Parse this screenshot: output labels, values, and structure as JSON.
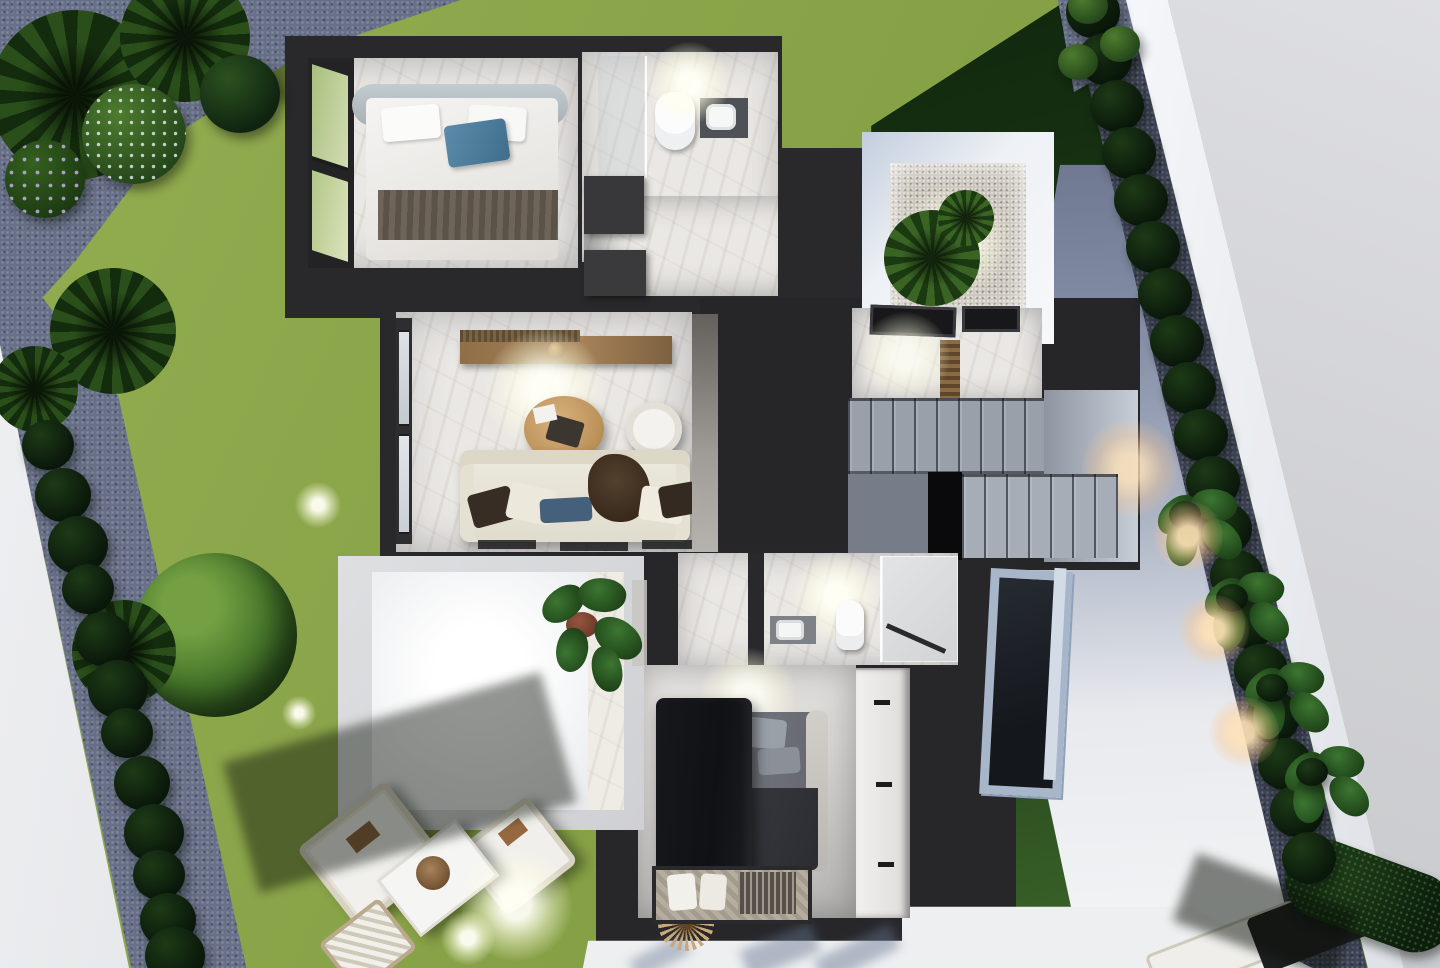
{
  "meta": {
    "title": "Aerial 3D cutaway floor plan render — modern villa, upper floor at dusk",
    "view": "top-down dollhouse",
    "time_of_day": "dusk with interior lights on"
  },
  "palette": {
    "lawn": "#88a247",
    "lawn_shadow": "#162e12",
    "wall_dark": "#29292b",
    "floor_marble": "#eae8e4",
    "gravel_blue": "#687089",
    "sidewalk": "#e9eaec",
    "street": "#d2d3d6",
    "boundary_wall": "#f3f5f8",
    "walkway_shadow": "#7d86a0",
    "stair_gray": "#99a0aa",
    "wood_console": "#9c7a50",
    "wood_table": "#c79e68",
    "sofa_cream": "#e7e3d8",
    "pillow_blue": "#45617c",
    "bed_pillow_blue": "#4e7d9c",
    "canopy_dark": "#141519",
    "plant_green": "#2e5d2b",
    "glow_warm": "#ffd9a8",
    "glow_cool": "#ffffff"
  },
  "building": {
    "rooms": [
      {
        "id": "bedroom-1",
        "name": "Bedroom 1",
        "features": [
          "double bed with white duvet",
          "blue accent pillow",
          "gray throw",
          "corner glass wall"
        ]
      },
      {
        "id": "bathroom-1",
        "name": "Bathroom 1",
        "features": [
          "walk-in shower",
          "wall-hung toilet",
          "washbasin on dark counter"
        ]
      },
      {
        "id": "hallway",
        "name": "Hallway",
        "features": [
          "built-in dark cabinets",
          "marble floor"
        ]
      },
      {
        "id": "living-room",
        "name": "Living room",
        "features": [
          "cream sofa with cushions",
          "round wood coffee table",
          "hanging egg chair",
          "wood TV sideboard",
          "floor-to-ceiling windows"
        ]
      },
      {
        "id": "stairwell",
        "name": "Staircase",
        "features": [
          "two flights",
          "intermediate landing",
          "open void",
          "skylights",
          "wood slat railing"
        ]
      },
      {
        "id": "courtyard",
        "name": "Light-well courtyard",
        "features": [
          "gravel bed",
          "tropical plant",
          "cove lighting"
        ]
      },
      {
        "id": "bathroom-2",
        "name": "Bathroom 2",
        "features": [
          "glass shower enclosure",
          "toilet",
          "vanity with basin"
        ]
      },
      {
        "id": "bedroom-2",
        "name": "Bedroom 2",
        "features": [
          "bed with dark bedding",
          "dark curtain canopy",
          "patterned rug with cushions",
          "wardrobe with drawer handles"
        ]
      },
      {
        "id": "roof-terrace",
        "name": "Lower roof terrace",
        "features": [
          "potted fiddle-leaf plant",
          "bright rooflight"
        ]
      }
    ]
  },
  "garden": {
    "areas": [
      "front lawn with palm shadows",
      "palm cluster with flowering shrubs",
      "curved blue-gravel path",
      "perimeter sidewalk",
      "shrub border rows",
      "white boundary wall",
      "side walkway with uplights",
      "clipped hedge",
      "rear patio"
    ],
    "furniture": [
      "two outdoor lounge sofas",
      "outdoor coffee table with rope basket",
      "striped sun lounger",
      "patio dining set with dried-grass centerpiece",
      "corner daybed"
    ],
    "lights": [
      "garden spike lights (cool)",
      "walkway uplights (warm)"
    ]
  }
}
